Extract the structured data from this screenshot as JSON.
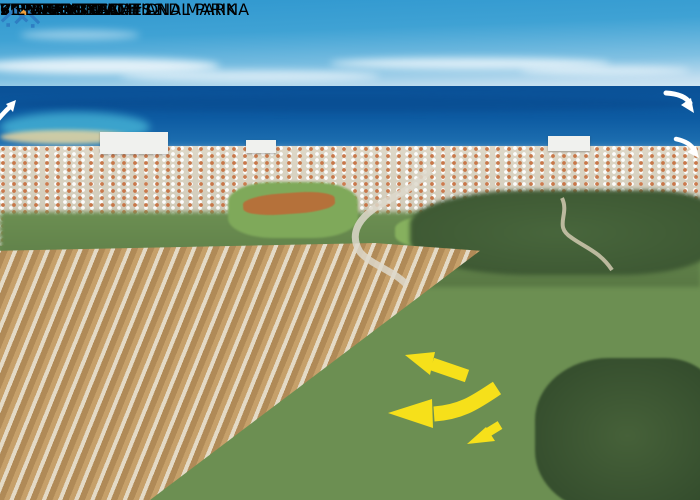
{
  "labels": {
    "kalamies": "KALAMIES BEACH AND MARINA",
    "pernera": "PERNERA TOWN",
    "several_beaches": "SEVERAL BEACHES",
    "cape_greco": "CAPE GRECO NATIONAL PARK",
    "protaras": "PROTARAS"
  },
  "villa_callouts": {
    "villa_10_12": {
      "title": "VILLA #10 AND #12",
      "subtitle": "3 BEDROOMS"
    },
    "villa_9": {
      "title": "VILLA #9",
      "subtitle": "2 BEDROOMS"
    }
  },
  "logo": {
    "brand": "VILLASCYPRUS"
  },
  "icons": {
    "cape_greco_arrow": "white-curved-arrow-down-right",
    "protaras_arrow": "white-curved-arrow-down-right",
    "kalamies_arrow": "white-curved-arrow-up-right",
    "villa_arrow_upper": "yellow-arrow-pointing-upper-left",
    "villa_arrow_main": "yellow-bent-arrow-pointing-left",
    "villa_arrow_small": "yellow-arrow-pointing-down-left",
    "dotted_pointer": "white-dotted-line",
    "logo_house": "double-house-roof"
  },
  "colors": {
    "label_yellow": "#FFE715",
    "label_white": "#FFFFFF",
    "label_text": "#000000",
    "arrow_yellow": "#F6E01A",
    "logo_blue": "#2E7EC2",
    "logo_orange": "#F0A03A",
    "sky_blue": "#2F97CF",
    "sea_blue": "#0D5BA2",
    "pool_blue": "#2F84C8"
  }
}
